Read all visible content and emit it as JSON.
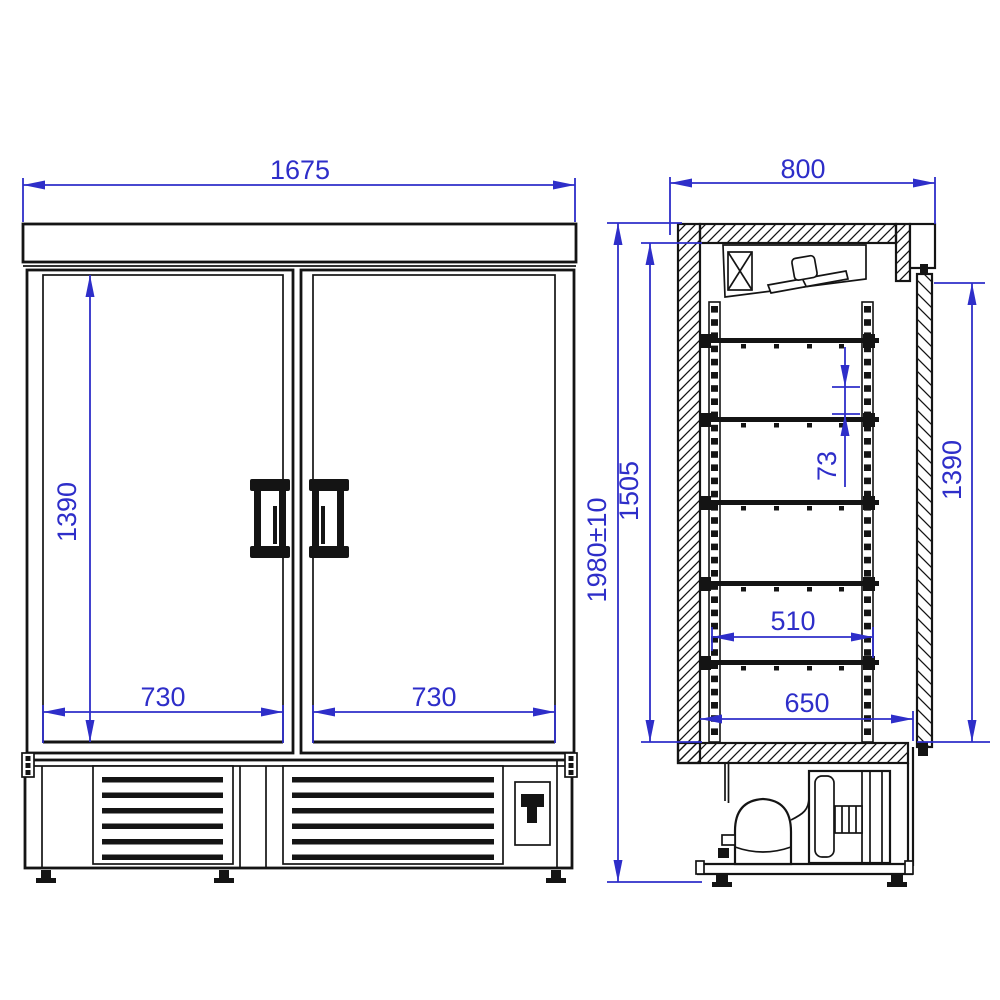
{
  "front_view": {
    "overall_width": "1675",
    "glass_height": "1390",
    "left_door_width": "730",
    "right_door_width": "730"
  },
  "side_view": {
    "depth": "800",
    "overall_height": "1980±10",
    "interior_height": "1505",
    "shelf_pitch": "73",
    "shelf_depth": "510",
    "interior_depth": "650",
    "door_height": "1390"
  },
  "colors": {
    "dimension": "#2E2EC9",
    "line": "#141414",
    "background": "#ffffff"
  }
}
